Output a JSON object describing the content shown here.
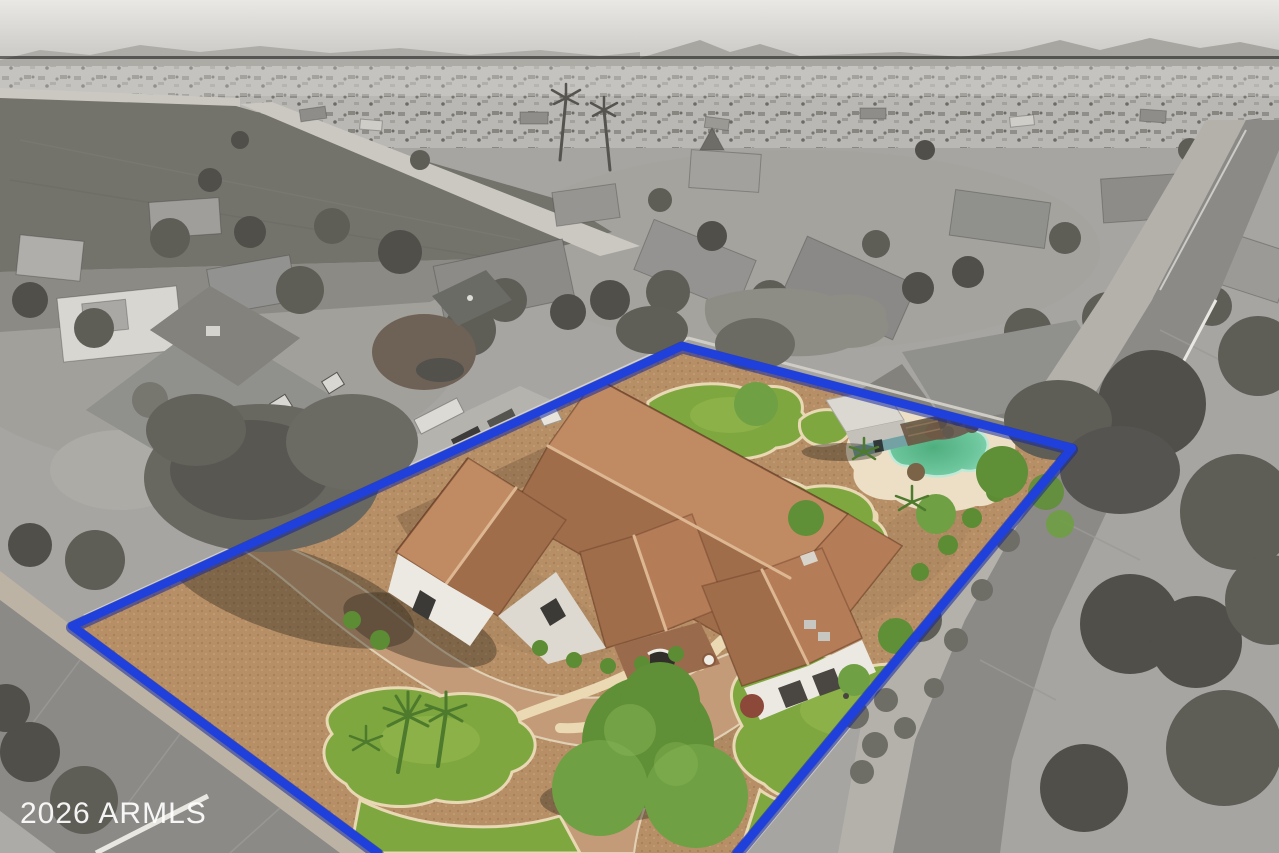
{
  "watermark": {
    "text": "2026 ARMLS"
  },
  "boundary": {
    "points": "378,853 72,626 682,346 1072,448 737,853",
    "color": "#2040dc",
    "halo_color": "#14279c"
  },
  "palette": {
    "sky_top": "#e6e5e2",
    "sky_bottom": "#c7c6c2",
    "mountain": "#a7a6a1",
    "sprawl": "#bab8b4",
    "ground": "#a7a5a1",
    "field": "#73726b",
    "field2": "#8b8a84",
    "road_dirt": "#cbc8c2",
    "street": "#8b8a86",
    "street_seam": "#9c9a96",
    "sidewalk": "#bcb3a4",
    "parkway": "#b4b1ab",
    "curb_white": "#e9e7e2",
    "roof_gray": "#90908c",
    "roof_gray2": "#83827d",
    "wall_gray": "#d6d4cf",
    "wall_light": "#cfccc6",
    "tree_gray": "#5e5d56",
    "tree_gray2": "#514f49",
    "bush_gray": "#6e6d66",
    "shadow": "#45423a",
    "gravel": "#b78f67",
    "gravel_dark": "#9c7a52",
    "paver": "#c49b79",
    "paver_edge": "#e0d0b4",
    "path": "#ead9b3",
    "lawn": "#7fa73f",
    "lawn_light": "#95b951",
    "lawn_edge": "#e8d8b4",
    "tree_green": "#5f8f36",
    "tree_green2": "#6fa044",
    "bush_green": "#5c8c34",
    "bush_red": "#8c4838",
    "palm_green": "#4d7a2c",
    "roof_tile": "#b57c58",
    "roof_tile_light": "#c08a63",
    "roof_tile_dark": "#a06d4b",
    "ridge": "#dcb792",
    "stucco": "#ece9e2",
    "stone": "#9a6a4c",
    "window_dark": "#3c3a36",
    "pool_edge": "#bfe9d6",
    "pool_light": "#93dbbc",
    "pool_deep": "#4fae7e",
    "deck": "#ecdfc6",
    "casita_roof": "#dbd8d2",
    "casita_wall": "#74a1a4",
    "pergola": "#6d5844",
    "rock": "#6e6257",
    "boundary": "#2040dc",
    "boundary_halo": "#14279c",
    "watermark": "#ffffff"
  }
}
